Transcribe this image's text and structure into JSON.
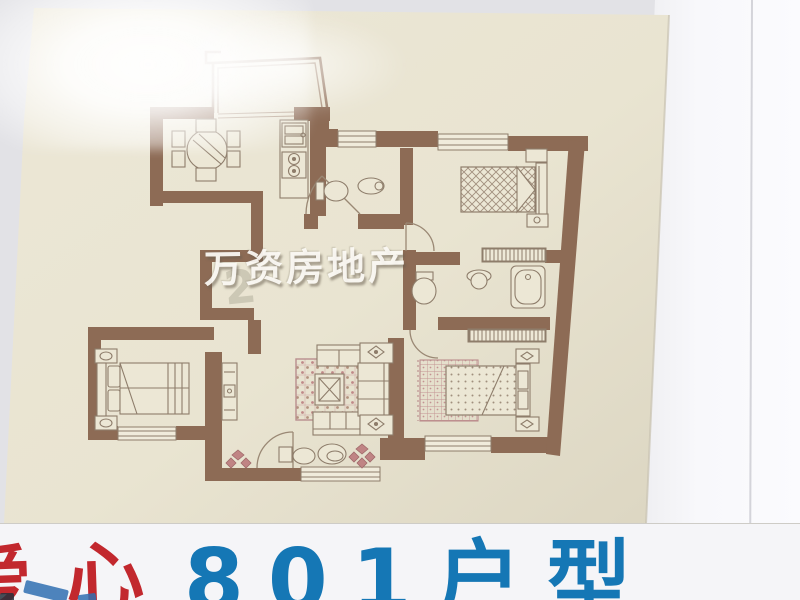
{
  "photo": {
    "watermark": {
      "text": "万资房地产",
      "ghost_text": "2"
    },
    "caption": {
      "red_text": "爱心",
      "blue_text": "801户型"
    },
    "colors": {
      "paper_cream": "#e9e4d1",
      "wall_brown": "#8d6b55",
      "furniture_line": "#8e7d6b",
      "accent_pink": "#c28d8d",
      "caption_red": "#c2282e",
      "caption_blue": "#1577b5",
      "background_gray": "#e4e4e8",
      "caption_band_white": "#f5f5f8"
    }
  }
}
